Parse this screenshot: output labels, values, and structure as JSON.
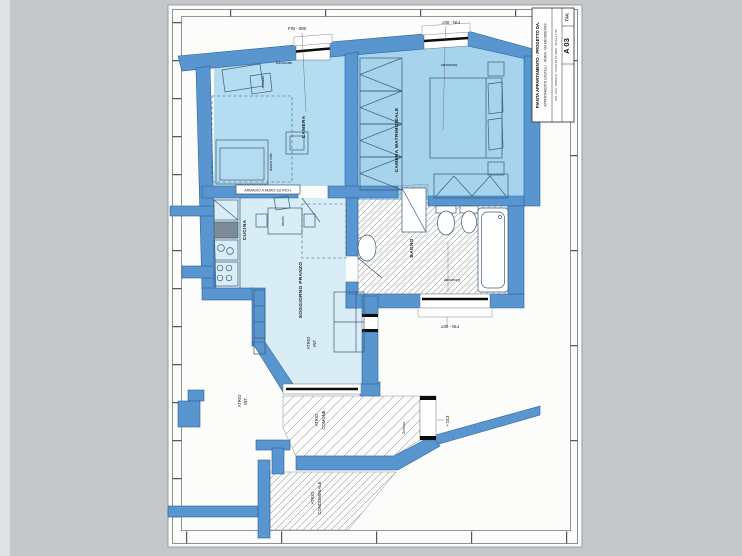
{
  "drawing": {
    "rooms": {
      "camera": "CAMERA",
      "camera_matrimoniale": "CAMERA MATRIMONIALE",
      "cucina": "CUCINA",
      "soggiorno_pranzo": "SOGGIORNO PRANZO",
      "bagno": "BAGNO",
      "atrio_int_1": "ATRIO",
      "atrio_int_2": "INT.",
      "atrio_comune_1": "ATRIO",
      "atrio_comune_2": "COMUNE",
      "atrio_cond_1": "ATRIO",
      "atrio_cond_2": "CONDOMINIALE"
    },
    "windows": {
      "fin_008": "FIN - 008",
      "fin_007": "FIN - 007",
      "davanzale": "Davanzale"
    },
    "furniture": {
      "armadio": "armadio",
      "divano_letto": "divano letto",
      "tavolo": "tavolo",
      "armadio_a_muro": "ARMADIO A MURO SU RICH.",
      "zerbino": "Zerbino"
    },
    "dimensions": {
      "quota_entrata": "+ 013"
    },
    "colors": {
      "wall": "#5995ce",
      "camera_fill": "#b5ddf2",
      "matrimoniale_fill": "#a6d4ed",
      "living_fill": "#d8edf6",
      "paper": "#fcfcfa",
      "background": "#c4c8ca"
    }
  },
  "title_block": {
    "tav_label": "TAV.",
    "tav_number": "A 03",
    "line1": "PIANTA APPARTAMENTO - PROGETTO DA.",
    "line2": "APPARTAMENTO CASTELLI - ROMA - VIA ANCONETANI",
    "line3": "DIS. UA4 - MINUTE - DATA 28.07.2006 - SCALA 1:50"
  }
}
